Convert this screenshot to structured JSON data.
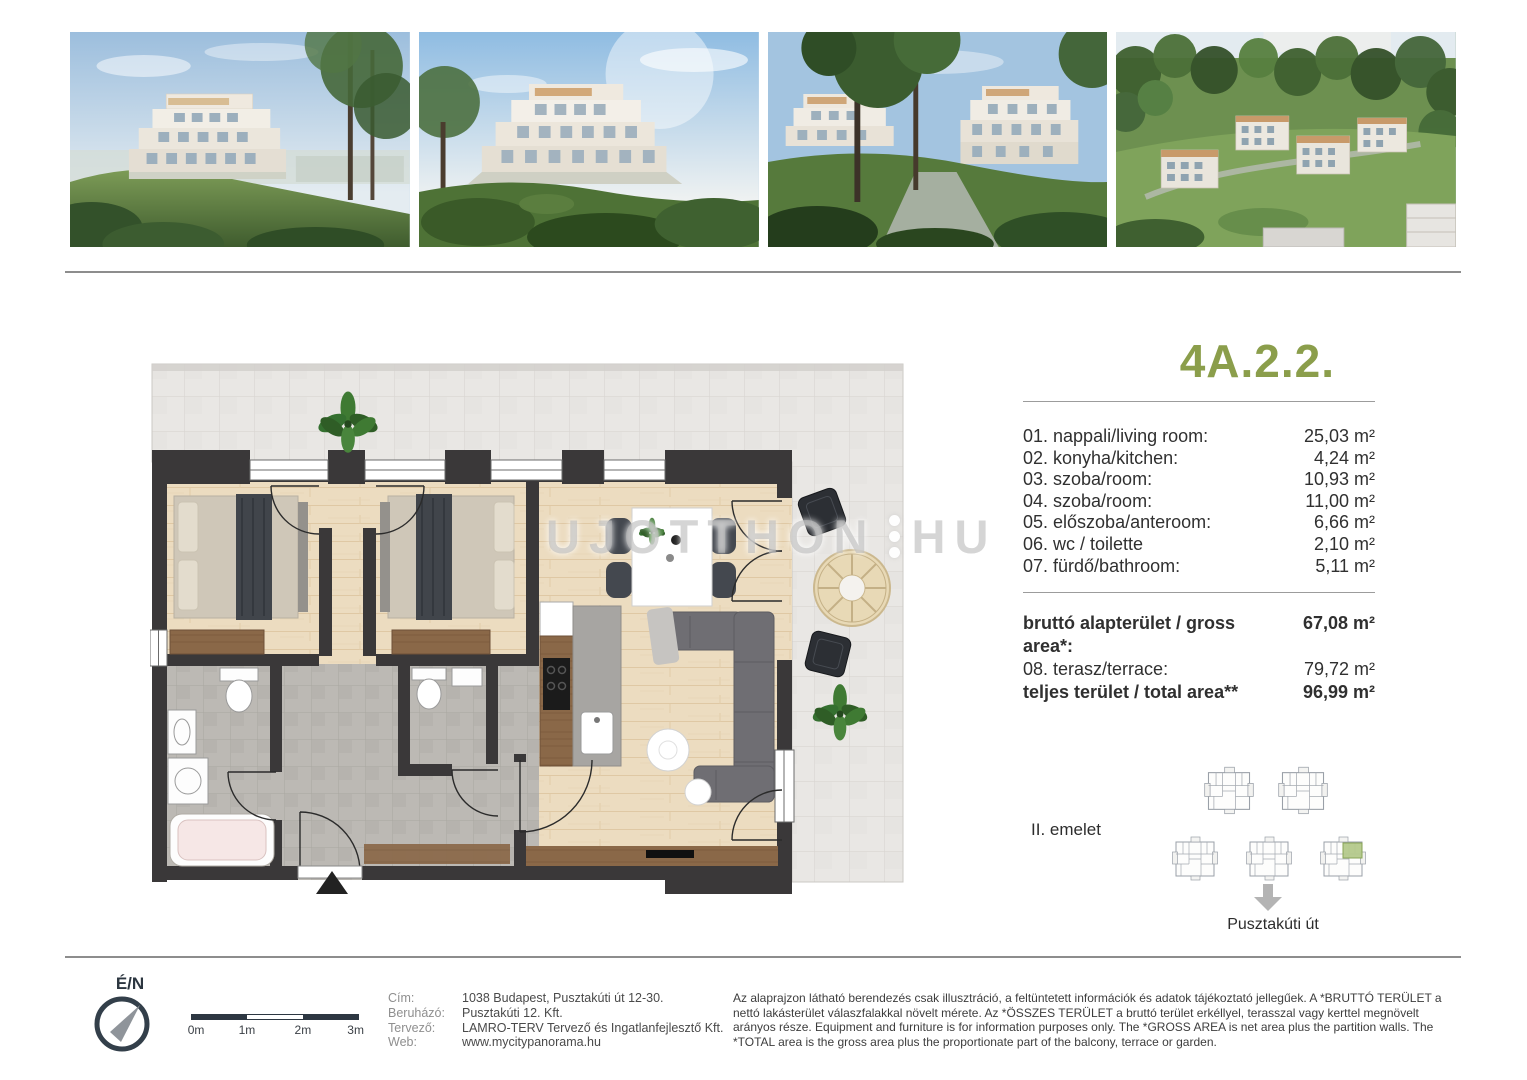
{
  "unit": {
    "title": "4A.2.2."
  },
  "rooms": [
    {
      "label": "01. nappali/living room:",
      "value": "25,03 m²"
    },
    {
      "label": "02. konyha/kitchen:",
      "value": "4,24 m²"
    },
    {
      "label": "03. szoba/room:",
      "value": "10,93 m²"
    },
    {
      "label": "04. szoba/room:",
      "value": "11,00 m²"
    },
    {
      "label": "05. előszoba/anteroom:",
      "value": "6,66 m²"
    },
    {
      "label": "06. wc / toilette",
      "value": "2,10 m²"
    },
    {
      "label": "07. fürdő/bathroom:",
      "value": "5,11 m²"
    }
  ],
  "summary": [
    {
      "label": "bruttó alapterület / gross area*:",
      "value": "67,08 m²"
    },
    {
      "label": "08. terasz/terrace:",
      "value": "79,72 m²"
    },
    {
      "label": "teljes terület / total area**",
      "value": "96,99 m²"
    }
  ],
  "floor_info": {
    "level": "II. emelet",
    "street": "Pusztakúti út"
  },
  "watermark": {
    "text": "UJOTTHON",
    "suffix": "HU"
  },
  "photos": [
    {
      "name": "building-render-hillside-view"
    },
    {
      "name": "building-render-garden-view"
    },
    {
      "name": "building-render-two-blocks"
    },
    {
      "name": "building-render-aerial-view"
    }
  ],
  "footer": {
    "compass_label": "É/N",
    "scale_ticks": [
      "0m",
      "1m",
      "2m",
      "3m"
    ],
    "contacts": [
      {
        "label": "Cím:",
        "value": "1038 Budapest, Pusztakúti út 12-30."
      },
      {
        "label": "Beruházó:",
        "value": "Pusztakúti 12. Kft."
      },
      {
        "label": "Tervező:",
        "value": "LAMRO-TERV Tervező és Ingatlanfejlesztő Kft."
      },
      {
        "label": "Web:",
        "value": "www.mycitypanorama.hu"
      }
    ],
    "disclaimer": "Az alaprajzon látható berendezés csak illusztráció, a feltüntetett információk és adatok tájékoztató jellegűek. A *BRUTTÓ TERÜLET a nettó lakásterület válaszfalakkal növelt mérete. Az *ÖSSZES TERÜLET a bruttó terület erkéllyel, terasszal vagy kerttel megnövelt arányos része. Equipment and furniture is for information purposes only. The *GROSS AREA is net area plus the partition walls. The *TOTAL area is the gross area plus the proportionate part of the balcony, terrace or garden."
  },
  "colors": {
    "accent_green": "#8b9e4b",
    "wall_dark": "#3a3839",
    "highlight_green": "#b5ca8c",
    "terrace_tile": "#e9e7e4",
    "wood_floor": "#ecdcc0"
  }
}
